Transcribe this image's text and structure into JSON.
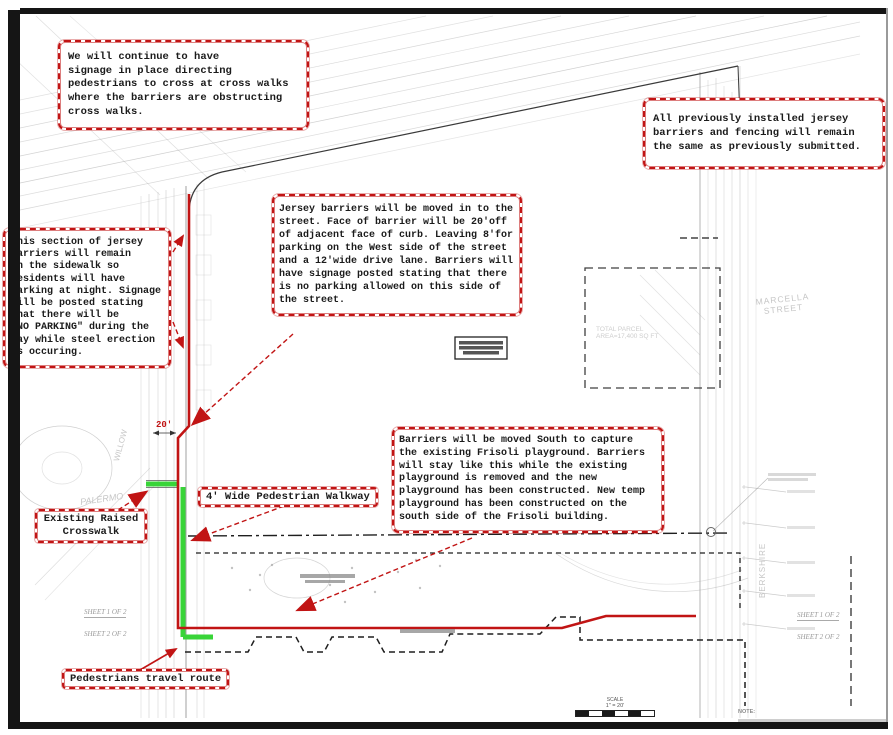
{
  "colors": {
    "annotation_red": "#c11414",
    "route_green": "#38d438"
  },
  "callouts": {
    "signage_top": "We will continue to have\nsignage in place directing\npedestrians to cross at cross walks\nwhere the barriers are obstructing\ncross walks.",
    "previously_installed": "All previously installed jersey\nbarriers and fencing will remain\nthe same as previously submitted.",
    "no_parking_section": "This section of jersey\nbarriers will remain\non the sidewalk so\nresidents will have\nparking at night. Signage\nwill be posted stating\nthat there will be\n\"NO PARKING\" during the\nday while steel erection\nis occuring.",
    "jersey_moved": "Jersey barriers will be moved in to the\nstreet. Face of barrier will be 20'off\nof adjacent face of curb. Leaving 8'for\nparking on the West side of the street\nand a 12'wide drive lane. Barriers will\nhave signage posted stating that there\nis no parking allowed on this side of\nthe street.",
    "barriers_south": "Barriers will be moved South to capture\nthe existing Frisoli playground. Barriers\nwill stay like this while the existing\nplayground is removed and the new\nplayground has been constructed. New temp\nplayground has been constructed on the\nsouth side of the Frisoli building."
  },
  "labels": {
    "walkway": "4' Wide Pedestrian Walkway",
    "crosswalk": "Existing Raised\nCrosswalk",
    "travel_route": "Pedestrians travel route"
  },
  "dimension_label": "20'",
  "streets": {
    "marcella": "MARCELLA\nSTREET",
    "willow": "WILLOW",
    "palermo": "PALERMO",
    "berkshire": "BERKSHIRE"
  },
  "parcel_text": "TOTAL PARCEL\nAREA=17,400 SQ FT",
  "sheet_reference": {
    "line1": "SHEET 1 OF 2",
    "line2": "SHEET 2 OF 2"
  },
  "scale_bar": {
    "title": "SCALE",
    "value": "1\" = 20'"
  },
  "note_label": "NOTE:"
}
